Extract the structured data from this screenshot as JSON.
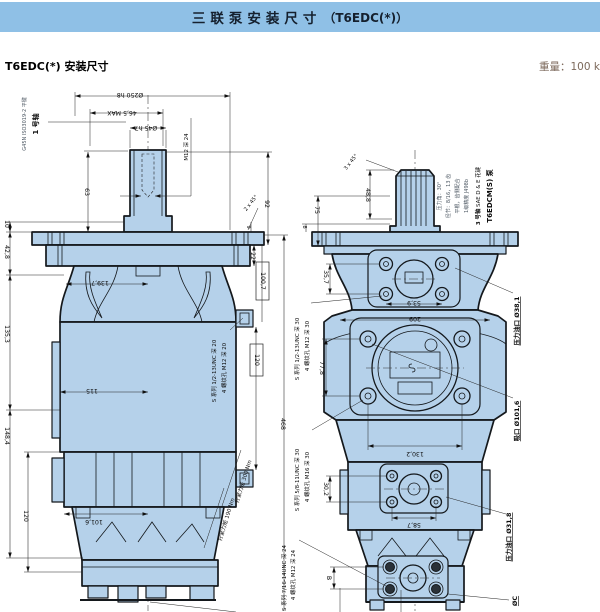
{
  "colors": {
    "header_bg": "#8fc0e6",
    "drawing_fill": "#b5d1ea",
    "weight_color": "#7d6a5c"
  },
  "header": {
    "title_cn": "三联泵安装尺寸",
    "title_suffix": "（T6EDC(*)）"
  },
  "subheader": {
    "title": "T6EDC(*) 安装尺寸",
    "weight": "重量：100 kg"
  },
  "left": {
    "labels": {
      "shaft_no": "1 号轴",
      "shaft_spec": "G45N ISO3019-2 平键",
      "thread": "M12 深 24",
      "torque_300": "拧紧力矩 300 Nm",
      "torque_190": "拧紧力矩 190 Nm",
      "note_holes": "4 螺纹孔 M12 深 20",
      "note_holes_s": "S 系列 1/2-13UNC 深 20"
    },
    "dims": {
      "pilot": "Ø250 h8",
      "key": "46,5 MAX",
      "shaft": "Ø45 h7",
      "len63": "63",
      "d10": "10",
      "d42": "42,8",
      "d135": "135,3",
      "d148": "148,4",
      "d120": "120",
      "d139": "139,7",
      "d115": "115",
      "d101": "101,6",
      "d92": "92",
      "d22": "22",
      "d100": "100,7",
      "d120b": "120",
      "d468": "468",
      "d9": "9",
      "chamfer": "2 x 45°"
    }
  },
  "right": {
    "labels": {
      "pump": "T6EDCM(S) 泵",
      "shaft_no": "3 号轴",
      "spline": " SAE D & E 花键",
      "spec1": "1级精度 J498b",
      "spec2": "平根，齿侧配合",
      "spec3": "径节：8/16，13 齿",
      "spec4": "压力角：30°",
      "port_p1": "压力油口 Ø38,1",
      "port_suction": "吸口 Ø101,6",
      "port_p2": "压力油口 Ø31,8",
      "port_p3": "ØC",
      "note1a": "4 螺纹孔 M12 深 30",
      "note1b": "S 系列 1/2-13UNC 深 30",
      "note2a": "4 螺纹孔 M16 深 30",
      "note2b": "S 系列 5/8-11UNC 深 30",
      "note3a": "4 螺纹孔 M12 深 24",
      "note3b": "S 系列 7/16-14UNC 深 24"
    },
    "dims": {
      "chamfer": "3 x 45°",
      "d48": "48,8",
      "d75": "75",
      "d8": "8",
      "d35": "35,7",
      "d53": "53,9",
      "d209": "209",
      "d77": "77,8",
      "d130": "130,2",
      "d30": "30,2",
      "d58": "58,7",
      "dB": "B"
    }
  }
}
